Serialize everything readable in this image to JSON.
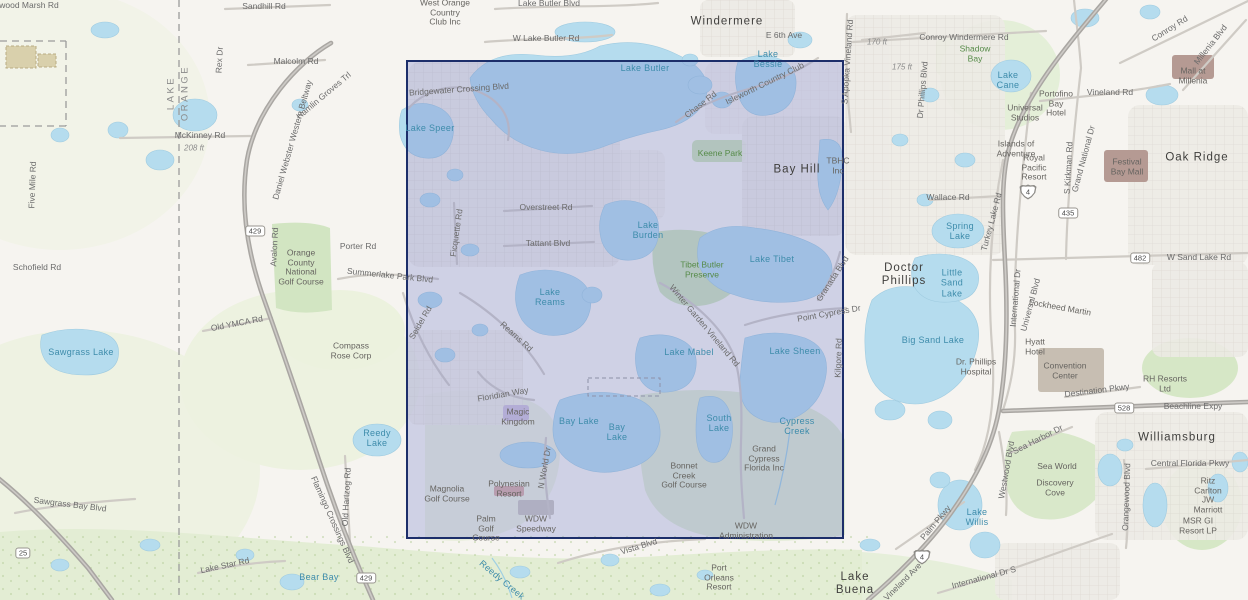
{
  "map": {
    "title": "Topographic basemap with selection extent (Windermere / Bay Hill / Walt Disney World area)",
    "colors": {
      "land": "#f6f4f0",
      "water": "#b5dcee",
      "vegetation": "#dde9cd",
      "urban": "#edebe6",
      "highway": "#a9a6a2",
      "road": "#cfcbc5",
      "extent_fill": "rgba(108,118,200,0.28)",
      "extent_stroke": "#1c2e6a",
      "water_label": "#3e8cab",
      "green_label": "#558a47"
    },
    "overlay": {
      "x": 406,
      "y": 60,
      "width": 438,
      "height": 479,
      "fill": "rgba(108,118,200,0.28)",
      "stroke": "#1c2e6a"
    },
    "shields": [
      {
        "num": "429",
        "x": 255,
        "y": 231,
        "type": "sr"
      },
      {
        "num": "429",
        "x": 366,
        "y": 578,
        "type": "sr"
      },
      {
        "num": "25",
        "x": 23,
        "y": 553,
        "type": "sr"
      },
      {
        "num": "435",
        "x": 1068,
        "y": 213,
        "type": "sr"
      },
      {
        "num": "482",
        "x": 1140,
        "y": 258,
        "type": "sr"
      },
      {
        "num": "528",
        "x": 1124,
        "y": 408,
        "type": "sr"
      },
      {
        "num": "4",
        "x": 1028,
        "y": 192,
        "type": "interstate"
      },
      {
        "num": "4",
        "x": 922,
        "y": 557,
        "type": "interstate"
      }
    ],
    "labels": [
      {
        "t": "wood Marsh Rd",
        "x": 29,
        "y": 6,
        "c": "road"
      },
      {
        "t": "Sandhill Rd",
        "x": 264,
        "y": 7,
        "c": "road"
      },
      {
        "t": "Rex Dr",
        "x": 220,
        "y": 60,
        "c": "road",
        "r": -87
      },
      {
        "t": "Malcolm Rd",
        "x": 296,
        "y": 62,
        "c": "road"
      },
      {
        "t": "McKinney Rd",
        "x": 200,
        "y": 136,
        "c": "road"
      },
      {
        "t": "208 ft",
        "x": 194,
        "y": 148,
        "c": "elev"
      },
      {
        "t": "170 ft",
        "x": 877,
        "y": 42,
        "c": "elev"
      },
      {
        "t": "175 ft",
        "x": 902,
        "y": 67,
        "c": "elev"
      },
      {
        "t": "Five Mile Rd",
        "x": 33,
        "y": 185,
        "c": "road",
        "r": -88
      },
      {
        "t": "Daniel Webster Western Beltway",
        "x": 293,
        "y": 140,
        "c": "road",
        "r": -74
      },
      {
        "t": "Hamlin Groves Trl",
        "x": 324,
        "y": 96,
        "c": "road",
        "r": -40
      },
      {
        "t": "Lake Butler Blvd",
        "x": 549,
        "y": 4,
        "c": "road"
      },
      {
        "t": "W Lake Butler Rd",
        "x": 546,
        "y": 39,
        "c": "road"
      },
      {
        "t": "E 6th Ave",
        "x": 784,
        "y": 36,
        "c": "road"
      },
      {
        "t": "Conroy Windermere Rd",
        "x": 964,
        "y": 38,
        "c": "road"
      },
      {
        "t": "S Apopka Vineland Rd",
        "x": 848,
        "y": 62,
        "c": "road",
        "r": -86
      },
      {
        "t": "Dr Phillips Blvd",
        "x": 923,
        "y": 90,
        "c": "road",
        "r": -85
      },
      {
        "t": "Conroy Rd",
        "x": 1170,
        "y": 29,
        "c": "road",
        "r": -32
      },
      {
        "t": "Millenia Blvd",
        "x": 1211,
        "y": 45,
        "c": "road",
        "r": -52
      },
      {
        "t": "Vineland Rd",
        "x": 1110,
        "y": 93,
        "c": "road"
      },
      {
        "t": "S Kirkman Rd",
        "x": 1069,
        "y": 168,
        "c": "road",
        "r": -87
      },
      {
        "t": "Grand National Dr",
        "x": 1084,
        "y": 159,
        "c": "road",
        "r": -75
      },
      {
        "t": "Wallace Rd",
        "x": 948,
        "y": 198,
        "c": "road"
      },
      {
        "t": "Turkey Lake Rd",
        "x": 992,
        "y": 222,
        "c": "road",
        "r": -75
      },
      {
        "t": "W Sand Lake Rd",
        "x": 1199,
        "y": 258,
        "c": "road"
      },
      {
        "t": "International Dr",
        "x": 1016,
        "y": 298,
        "c": "road",
        "r": -85
      },
      {
        "t": "Universal Blvd",
        "x": 1031,
        "y": 305,
        "c": "road",
        "r": -75
      },
      {
        "t": "Destination Pkwy",
        "x": 1097,
        "y": 391,
        "c": "road",
        "r": -7
      },
      {
        "t": "Beachline Expy",
        "x": 1193,
        "y": 407,
        "c": "road"
      },
      {
        "t": "Central Florida Pkwy",
        "x": 1190,
        "y": 464,
        "c": "road"
      },
      {
        "t": "Sea Harbor Dr",
        "x": 1038,
        "y": 440,
        "c": "road",
        "r": -27
      },
      {
        "t": "Westwood Blvd",
        "x": 1007,
        "y": 470,
        "c": "road",
        "r": -80
      },
      {
        "t": "Orangewood Blvd",
        "x": 1127,
        "y": 497,
        "c": "road",
        "r": -88
      },
      {
        "t": "Palm Pkwy",
        "x": 936,
        "y": 523,
        "c": "road",
        "r": -50
      },
      {
        "t": "International Dr S",
        "x": 984,
        "y": 578,
        "c": "road",
        "r": -15
      },
      {
        "t": "Vineland Ave",
        "x": 903,
        "y": 582,
        "c": "road",
        "r": -45
      },
      {
        "t": "Chase Rd",
        "x": 701,
        "y": 105,
        "c": "road",
        "r": -38
      },
      {
        "t": "Isleworth Country Club",
        "x": 765,
        "y": 84,
        "c": "road",
        "r": -26
      },
      {
        "t": "Bridgewater Crossing Blvd",
        "x": 459,
        "y": 90,
        "c": "road",
        "r": -4
      },
      {
        "t": "Overstreet Rd",
        "x": 546,
        "y": 208,
        "c": "road"
      },
      {
        "t": "Ficquette Rd",
        "x": 457,
        "y": 233,
        "c": "road",
        "r": -82
      },
      {
        "t": "Tattant Blvd",
        "x": 548,
        "y": 244,
        "c": "road"
      },
      {
        "t": "Winter Garden Vineland Rd",
        "x": 704,
        "y": 326,
        "c": "road",
        "r": 50
      },
      {
        "t": "Point Cypress Dr",
        "x": 829,
        "y": 314,
        "c": "road",
        "r": -10
      },
      {
        "t": "Granada Blvd",
        "x": 833,
        "y": 279,
        "c": "road",
        "r": -57
      },
      {
        "t": "Kilgore Rd",
        "x": 839,
        "y": 358,
        "c": "road",
        "r": -88
      },
      {
        "t": "Reams Rd",
        "x": 516,
        "y": 337,
        "c": "road",
        "r": 42
      },
      {
        "t": "Seidel Rd",
        "x": 421,
        "y": 323,
        "c": "road",
        "r": -60
      },
      {
        "t": "Summerlake Park Blvd",
        "x": 390,
        "y": 276,
        "c": "road",
        "r": 6
      },
      {
        "t": "Floridian Way",
        "x": 503,
        "y": 395,
        "c": "road",
        "r": -10
      },
      {
        "t": "N World Dr",
        "x": 545,
        "y": 468,
        "c": "road",
        "r": -80
      },
      {
        "t": "Vista Blvd",
        "x": 639,
        "y": 547,
        "c": "road",
        "r": -17
      },
      {
        "t": "Old Hartzog Rd",
        "x": 347,
        "y": 497,
        "c": "road",
        "r": -87
      },
      {
        "t": "Flamingo Crossings Blvd",
        "x": 332,
        "y": 520,
        "c": "road",
        "r": 66
      },
      {
        "t": "Sawgrass Bay Blvd",
        "x": 70,
        "y": 505,
        "c": "road",
        "r": 7
      },
      {
        "t": "Lake Star Rd",
        "x": 225,
        "y": 566,
        "c": "road",
        "r": -12
      },
      {
        "t": "Old YMCA Rd",
        "x": 237,
        "y": 324,
        "c": "road",
        "r": -11
      },
      {
        "t": "Porter Rd",
        "x": 358,
        "y": 247,
        "c": "road"
      },
      {
        "t": "Avalon Rd",
        "x": 275,
        "y": 247,
        "c": "road",
        "r": -87
      },
      {
        "t": "Schofield Rd",
        "x": 37,
        "y": 268,
        "c": "road"
      },
      {
        "t": "Lake Butler",
        "x": 645,
        "y": 68,
        "c": "water"
      },
      {
        "t": "Lake\nBessie",
        "x": 768,
        "y": 59,
        "c": "water"
      },
      {
        "t": "Lake Speer",
        "x": 430,
        "y": 128,
        "c": "water"
      },
      {
        "t": "Lake\nCane",
        "x": 1008,
        "y": 80,
        "c": "water"
      },
      {
        "t": "Spring\nLake",
        "x": 960,
        "y": 231,
        "c": "water"
      },
      {
        "t": "Little\nSand\nLake",
        "x": 952,
        "y": 283,
        "c": "water"
      },
      {
        "t": "Big Sand Lake",
        "x": 933,
        "y": 340,
        "c": "water"
      },
      {
        "t": "Lake\nBurden",
        "x": 648,
        "y": 230,
        "c": "water"
      },
      {
        "t": "Lake Tibet",
        "x": 772,
        "y": 259,
        "c": "water"
      },
      {
        "t": "Lake Sheen",
        "x": 795,
        "y": 351,
        "c": "water"
      },
      {
        "t": "Lake Mabel",
        "x": 689,
        "y": 352,
        "c": "water"
      },
      {
        "t": "Lake\nReams",
        "x": 550,
        "y": 297,
        "c": "water"
      },
      {
        "t": "Bay Lake",
        "x": 579,
        "y": 421,
        "c": "water"
      },
      {
        "t": "Bay\nLake",
        "x": 617,
        "y": 432,
        "c": "water"
      },
      {
        "t": "South\nLake",
        "x": 719,
        "y": 423,
        "c": "water"
      },
      {
        "t": "Cypress\nCreek",
        "x": 797,
        "y": 426,
        "c": "water"
      },
      {
        "t": "Lake\nWillis",
        "x": 977,
        "y": 517,
        "c": "water"
      },
      {
        "t": "Sawgrass Lake",
        "x": 81,
        "y": 352,
        "c": "water"
      },
      {
        "t": "Reedy\nLake",
        "x": 377,
        "y": 438,
        "c": "water"
      },
      {
        "t": "Bear Bay",
        "x": 319,
        "y": 577,
        "c": "water"
      },
      {
        "t": "Reedy Creek",
        "x": 502,
        "y": 580,
        "c": "water",
        "r": 40
      },
      {
        "t": "Shadow\nBay",
        "x": 975,
        "y": 54,
        "c": "green"
      },
      {
        "t": "Keene Park",
        "x": 720,
        "y": 154,
        "c": "green"
      },
      {
        "t": "Tibet Butler\nPreserve",
        "x": 702,
        "y": 270,
        "c": "green"
      },
      {
        "t": "Windermere",
        "x": 727,
        "y": 22,
        "c": "place"
      },
      {
        "t": "Bay Hill",
        "x": 797,
        "y": 170,
        "c": "place"
      },
      {
        "t": "Doctor\nPhillips",
        "x": 904,
        "y": 275,
        "c": "place"
      },
      {
        "t": "Oak Ridge",
        "x": 1197,
        "y": 158,
        "c": "place"
      },
      {
        "t": "Williamsburg",
        "x": 1177,
        "y": 438,
        "c": "place"
      },
      {
        "t": "Lake\nBuena",
        "x": 855,
        "y": 584,
        "c": "place"
      },
      {
        "t": "West Orange\nCountry\nClub Inc",
        "x": 445,
        "y": 13,
        "c": "poi"
      },
      {
        "t": "Universal\nStudios",
        "x": 1025,
        "y": 113,
        "c": "poi"
      },
      {
        "t": "Islands of\nAdventure",
        "x": 1016,
        "y": 149,
        "c": "poi"
      },
      {
        "t": "Royal\nPacific\nResort",
        "x": 1034,
        "y": 168,
        "c": "poi"
      },
      {
        "t": "Portofino\nBay\nHotel",
        "x": 1056,
        "y": 104,
        "c": "poi"
      },
      {
        "t": "Mall at\nMillenia",
        "x": 1193,
        "y": 76,
        "c": "poi"
      },
      {
        "t": "Festival\nBay Mall",
        "x": 1127,
        "y": 167,
        "c": "poi"
      },
      {
        "t": "Dr. Phillips\nHospital",
        "x": 976,
        "y": 367,
        "c": "poi"
      },
      {
        "t": "Lockheed Martin",
        "x": 1060,
        "y": 308,
        "c": "poi",
        "r": 10
      },
      {
        "t": "Hyatt\nHotel",
        "x": 1035,
        "y": 347,
        "c": "poi"
      },
      {
        "t": "Convention\nCenter",
        "x": 1065,
        "y": 371,
        "c": "poi"
      },
      {
        "t": "RH Resorts\nLtd",
        "x": 1165,
        "y": 384,
        "c": "poi"
      },
      {
        "t": "Sea World",
        "x": 1057,
        "y": 467,
        "c": "poi"
      },
      {
        "t": "Discovery\nCove",
        "x": 1055,
        "y": 488,
        "c": "poi"
      },
      {
        "t": "Ritz\nCarlton\nJW\nMarriott",
        "x": 1208,
        "y": 496,
        "c": "poi"
      },
      {
        "t": "MSR GI\nResort LP",
        "x": 1198,
        "y": 526,
        "c": "poi"
      },
      {
        "t": "TBHC\nInc",
        "x": 838,
        "y": 166,
        "c": "poi"
      },
      {
        "t": "Magic\nKingdom",
        "x": 518,
        "y": 417,
        "c": "poi"
      },
      {
        "t": "Magnolia\nGolf Course",
        "x": 447,
        "y": 494,
        "c": "poi"
      },
      {
        "t": "Polynesian\nResort",
        "x": 509,
        "y": 489,
        "c": "poi"
      },
      {
        "t": "Palm\nGolf\nCourse",
        "x": 486,
        "y": 529,
        "c": "poi"
      },
      {
        "t": "WDW\nSpeedway",
        "x": 536,
        "y": 524,
        "c": "poi"
      },
      {
        "t": "Grand\nCypress\nFlorida Inc",
        "x": 764,
        "y": 459,
        "c": "poi"
      },
      {
        "t": "Bonnet\nCreek\nGolf Course",
        "x": 684,
        "y": 476,
        "c": "poi"
      },
      {
        "t": "WDW\nAdministration",
        "x": 746,
        "y": 531,
        "c": "poi"
      },
      {
        "t": "Port\nOrleans\nResort",
        "x": 719,
        "y": 578,
        "c": "poi"
      },
      {
        "t": "Compass\nRose Corp",
        "x": 351,
        "y": 351,
        "c": "poi"
      },
      {
        "t": "Orange\nCounty\nNational\nGolf Course",
        "x": 301,
        "y": 268,
        "c": "poi"
      },
      {
        "t": "LAKE",
        "x": 172,
        "y": 93,
        "c": "cnty",
        "r": -90
      },
      {
        "t": "ORANGE",
        "x": 186,
        "y": 93,
        "c": "cnty",
        "r": -90
      }
    ]
  }
}
